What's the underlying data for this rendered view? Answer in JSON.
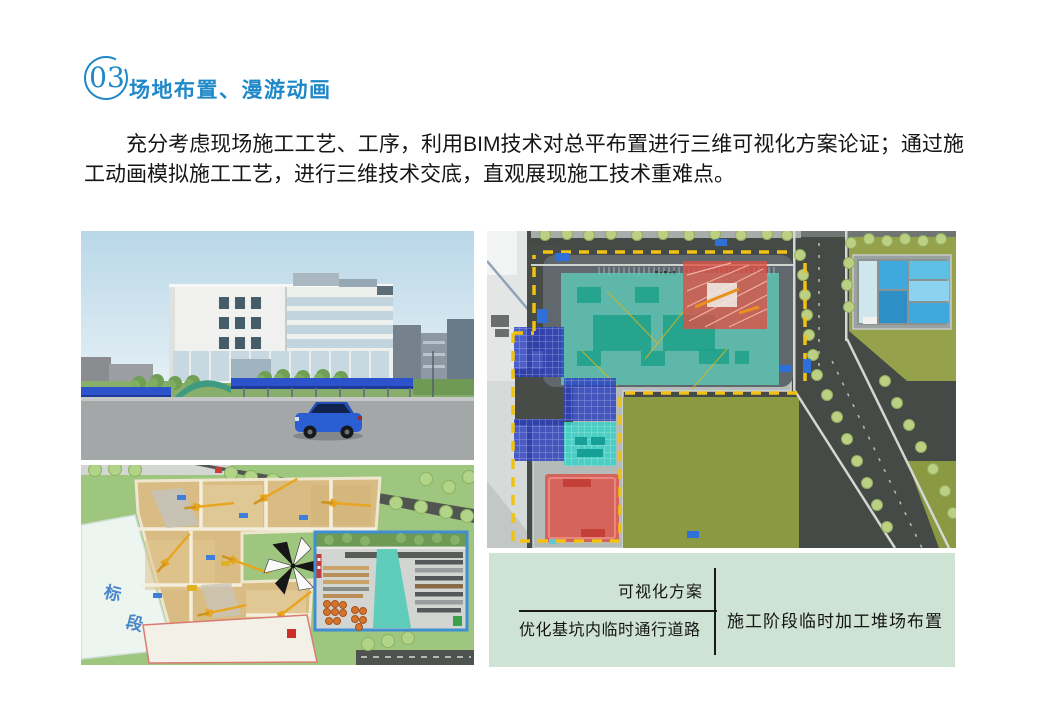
{
  "header": {
    "number": "03",
    "title": "场地布置、漫游动画"
  },
  "intro": "充分考虑现场施工工艺、工序，利用BIM技术对总平布置进行三维可视化方案论证；通过施工动画模拟施工工艺，进行三维技术交底，直观展现施工技术重难点。",
  "figures": {
    "excavation": {
      "plot_char_top": "标",
      "plot_char_bottom": "段"
    }
  },
  "caption": {
    "numerator": "可视化方案",
    "denominator": "优化基坑内临时通行道路",
    "right_label": "施工阶段临时加工堆场布置"
  },
  "colors": {
    "accent_blue": "#1e88c9",
    "caption_bg": "#cee3d4",
    "zone_teal": "#5ecdb8",
    "zone_teal_dark": "#1da189",
    "zone_red": "#dd5045",
    "zone_blue": "#2b3fc0",
    "zone_cyan": "#3ed0c6",
    "boundary_yellow": "#f2c213"
  }
}
